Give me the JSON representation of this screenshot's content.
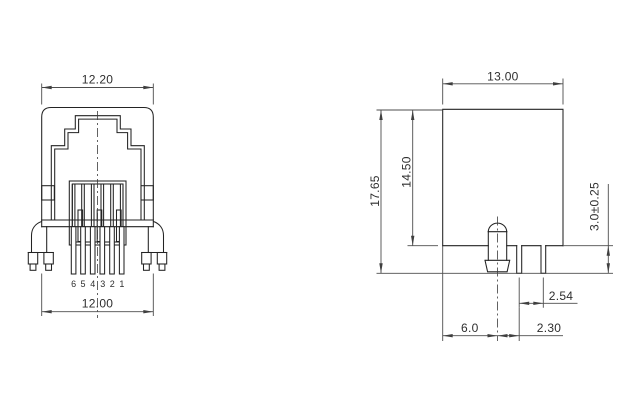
{
  "drawing": {
    "front_view": {
      "dim_width_top": "12.20",
      "dim_width_bottom": "12.00",
      "pin_numbers": [
        "6",
        "5",
        "4",
        "3",
        "2",
        "1"
      ]
    },
    "side_view": {
      "dim_width_top": "13.00",
      "dim_height_overall": "17.65",
      "dim_height_body": "14.50",
      "dim_pin_protrusion": "3.0±0.25",
      "dim_pin_pitch": "2.54",
      "dim_peg_offset": "6.0",
      "dim_peg_to_pin": "2.30"
    },
    "colors": {
      "background": "#ffffff",
      "outline": "#232323",
      "dimension": "#4d4d4d"
    }
  }
}
